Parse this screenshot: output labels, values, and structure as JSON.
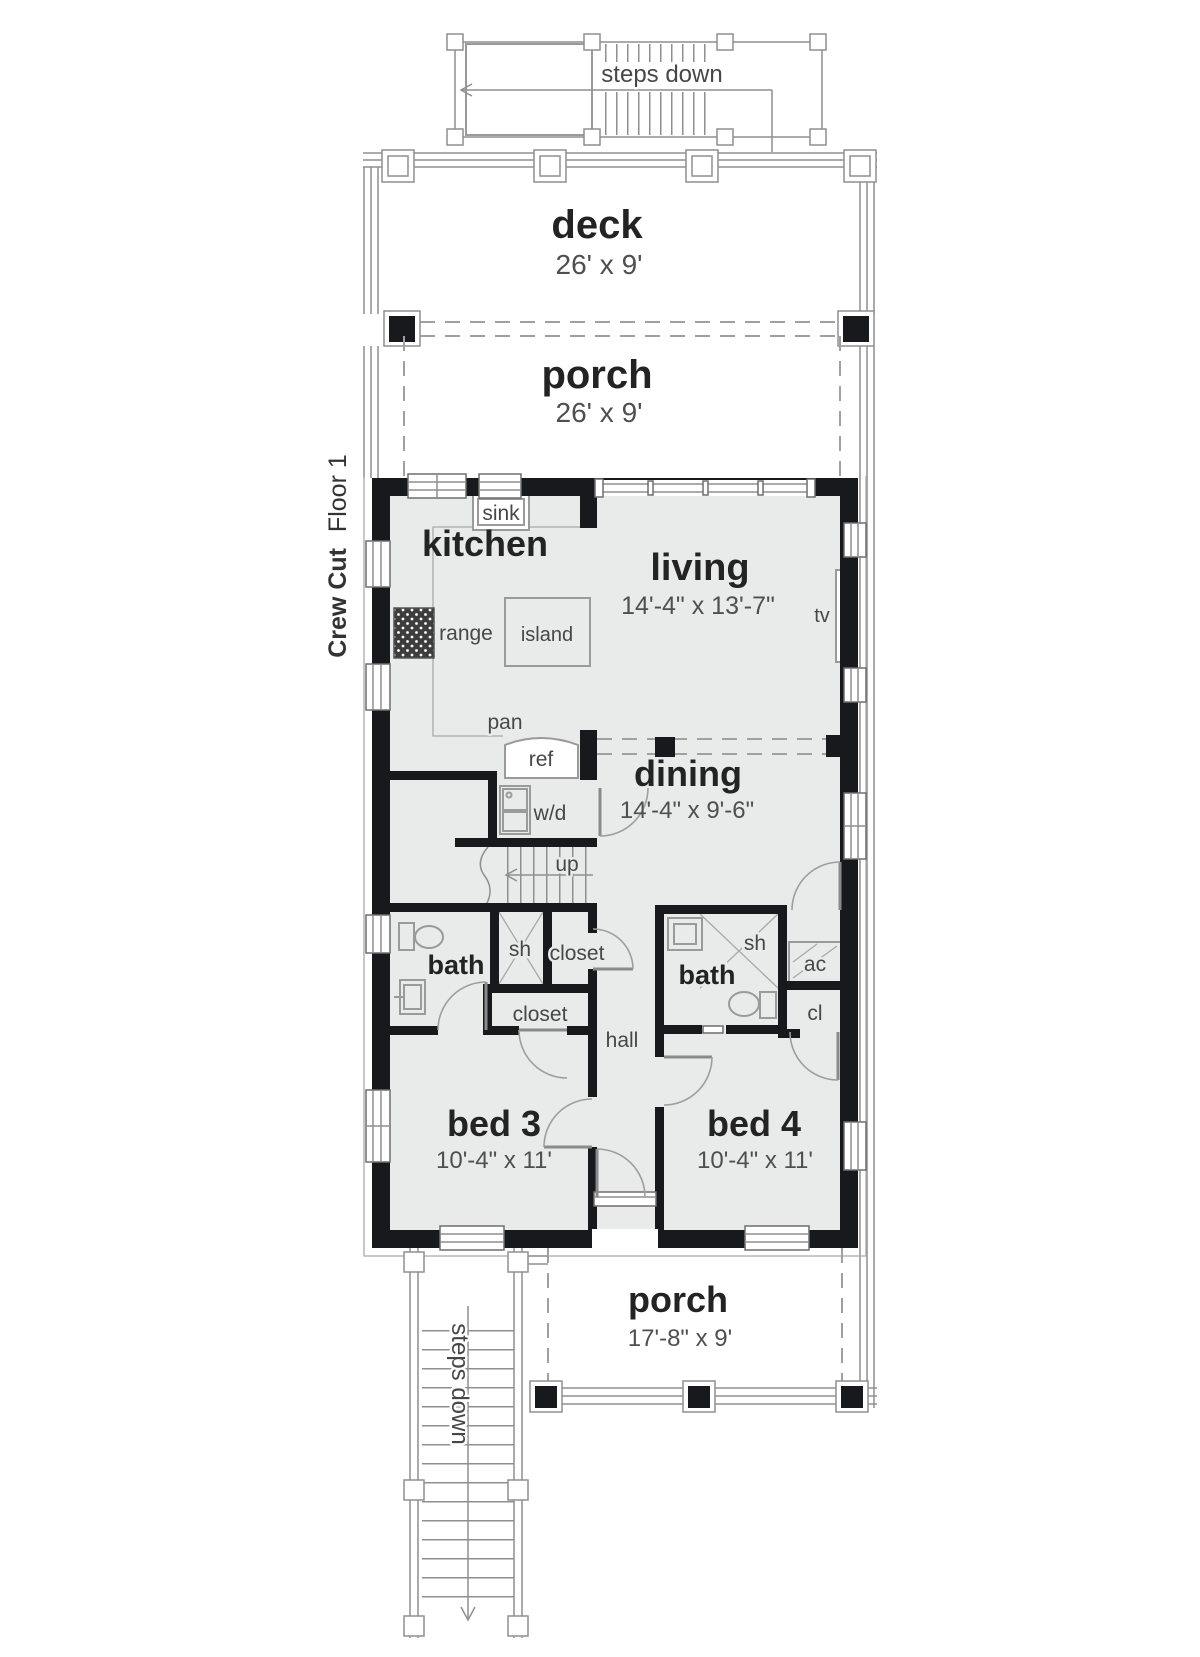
{
  "title": {
    "bold": "Crew Cut",
    "regular": "Floor 1"
  },
  "colors": {
    "floor": "#e9eaea",
    "wall": "#17191c",
    "text_dark": "#232323",
    "text_gray": "#4a4a4a"
  },
  "outdoor": {
    "steps_top": "steps down",
    "steps_bottom": "steps down",
    "deck": {
      "name": "deck",
      "dims": "26' x 9'"
    },
    "porch_top": {
      "name": "porch",
      "dims": "26' x 9'"
    },
    "porch_bottom": {
      "name": "porch",
      "dims": "17'-8\" x 9'"
    }
  },
  "rooms": {
    "kitchen": {
      "name": "kitchen"
    },
    "living": {
      "name": "living",
      "dims": "14'-4\" x 13'-7\""
    },
    "dining": {
      "name": "dining",
      "dims": "14'-4\" x 9'-6\""
    },
    "bed3": {
      "name": "bed 3",
      "dims": "10'-4\" x 11'"
    },
    "bed4": {
      "name": "bed 4",
      "dims": "10'-4\" x 11'"
    },
    "bath_left": {
      "name": "bath"
    },
    "bath_right": {
      "name": "bath"
    }
  },
  "labels": {
    "sink": "sink",
    "range": "range",
    "island": "island",
    "pan": "pan",
    "ref": "ref",
    "wd": "w/d",
    "up": "up",
    "sh_left": "sh",
    "sh_right": "sh",
    "closet_top": "closet",
    "closet_bottom": "closet",
    "hall": "hall",
    "ac": "ac",
    "cl": "cl",
    "tv": "tv"
  }
}
